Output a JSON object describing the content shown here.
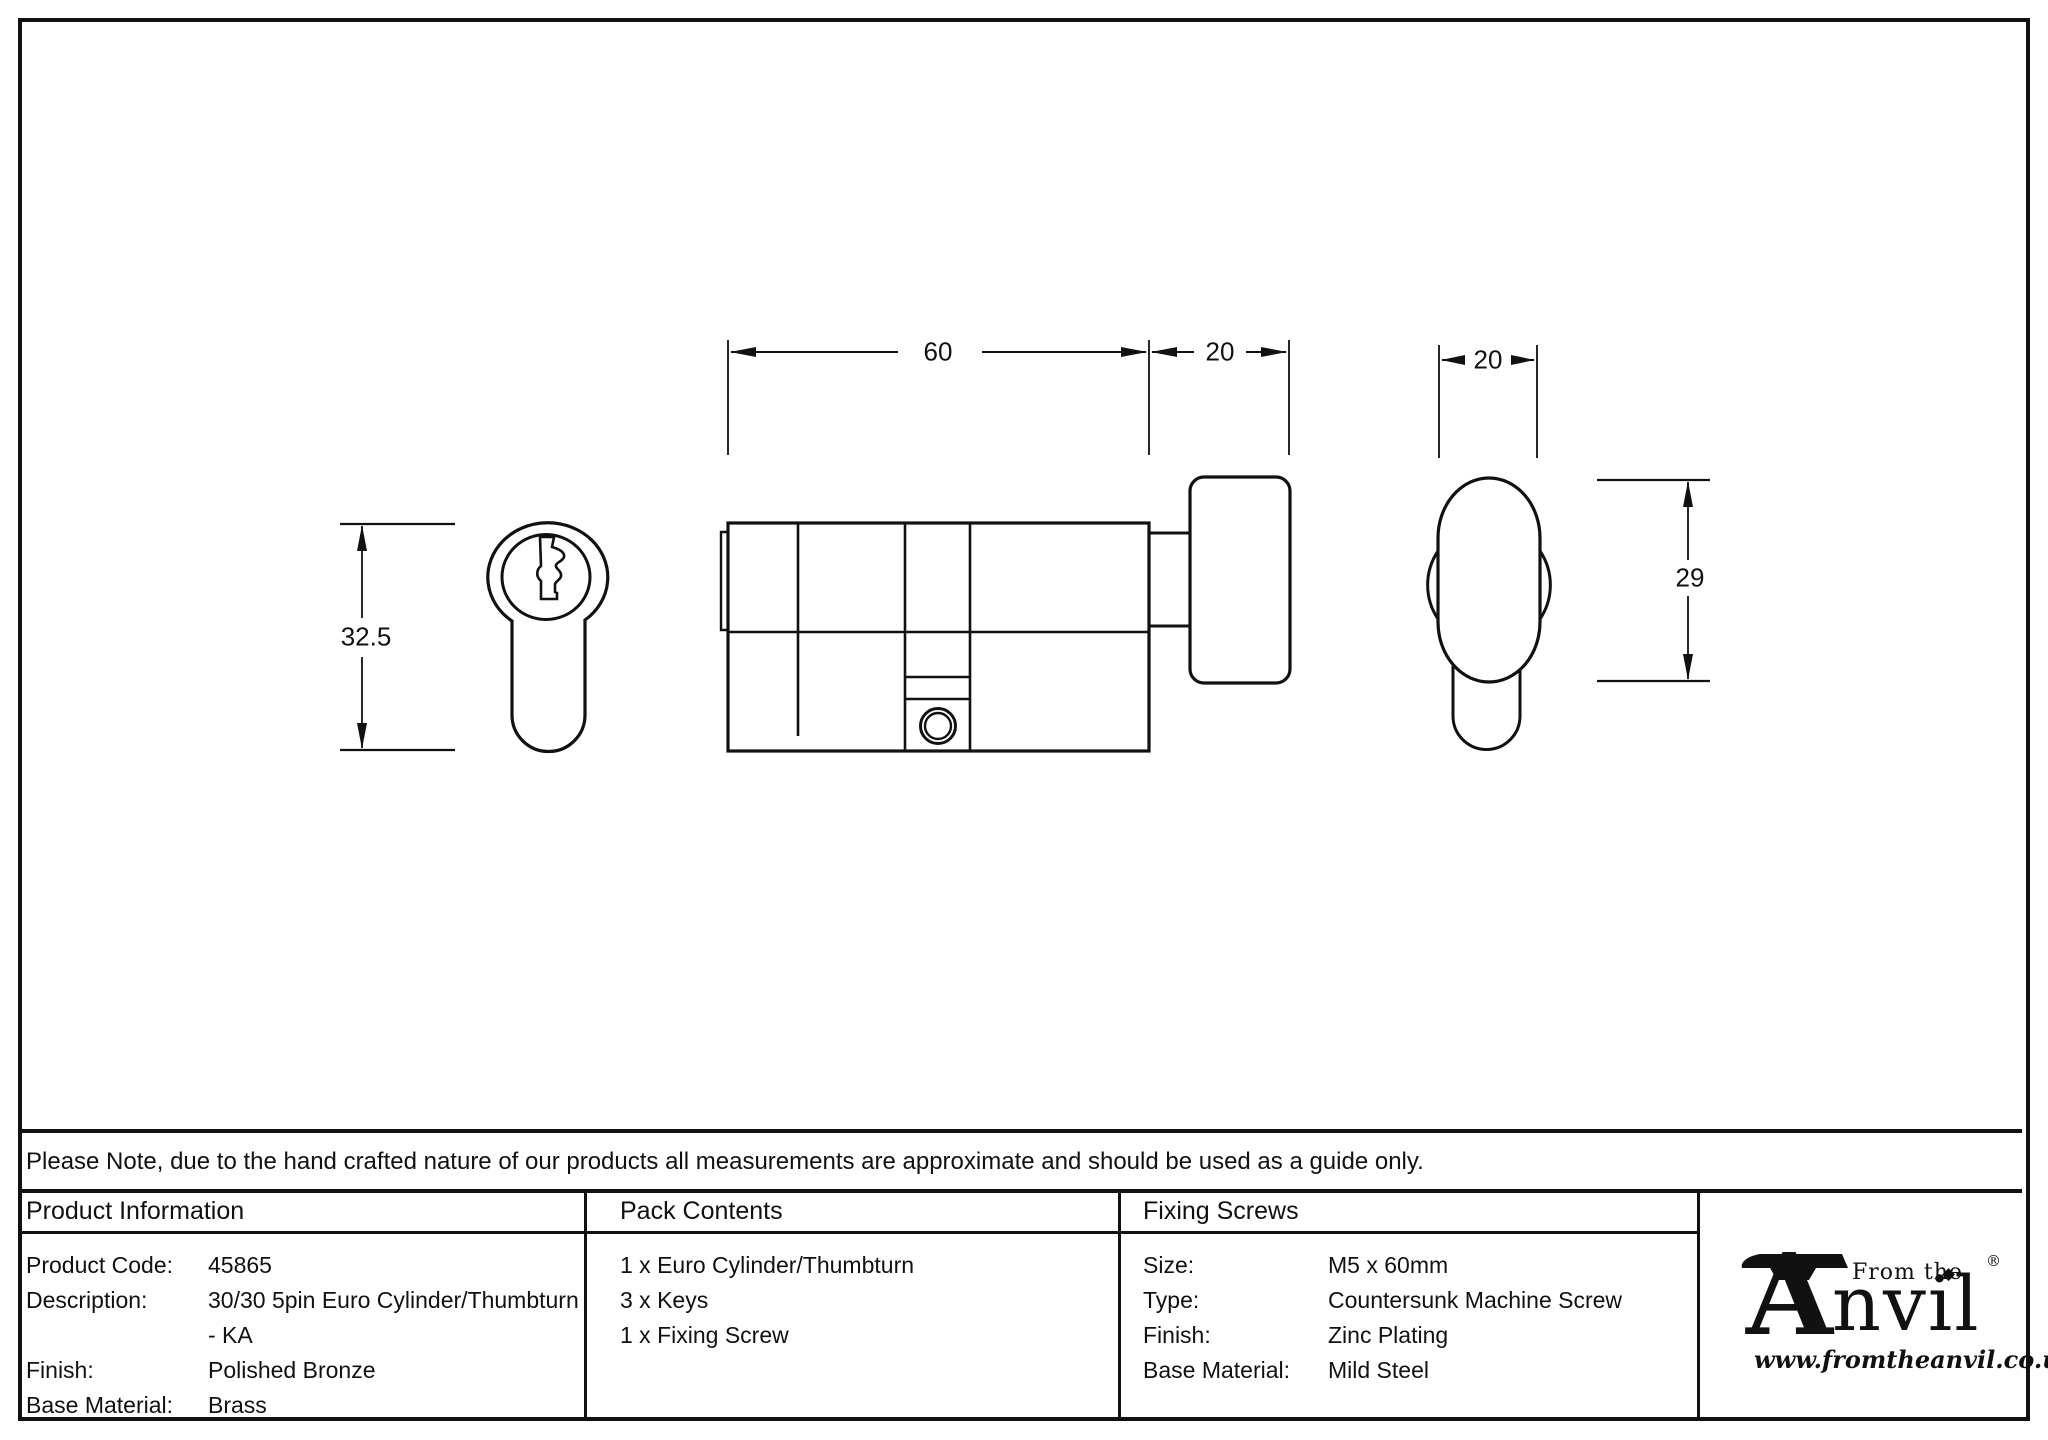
{
  "drawing": {
    "dim_labels": {
      "body_length": "60",
      "thumbturn_length": "20",
      "thumbturn_width": "20",
      "face_height": "32.5",
      "thumbturn_height": "29"
    }
  },
  "note": "Please Note, due to the hand crafted nature of our products all measurements are approximate and should be used as a guide only.",
  "table": {
    "product_information": {
      "header": "Product Information",
      "rows": [
        {
          "label": "Product Code:",
          "value": "45865"
        },
        {
          "label": "Description:",
          "value": "30/30 5pin Euro Cylinder/Thumbturn",
          "value2": "- KA"
        },
        {
          "label": "Finish:",
          "value": "Polished Bronze"
        },
        {
          "label": "Base Material:",
          "value": "Brass"
        }
      ]
    },
    "pack_contents": {
      "header": "Pack Contents",
      "items": [
        "1 x Euro Cylinder/Thumbturn",
        "3 x Keys",
        "1 x Fixing Screw"
      ]
    },
    "fixing_screws": {
      "header": "Fixing Screws",
      "rows": [
        {
          "label": "Size:",
          "value": "M5 x 60mm"
        },
        {
          "label": "Type:",
          "value": "Countersunk Machine Screw"
        },
        {
          "label": "Finish:",
          "value": "Zinc Plating"
        },
        {
          "label": "Base Material:",
          "value": "Mild Steel"
        }
      ]
    }
  },
  "logo": {
    "tagline": "From the",
    "brand_initial": "A",
    "brand_rest": "nvil",
    "registered": "®",
    "diamond": "◆",
    "url": "www.fromtheanvil.co.uk"
  }
}
